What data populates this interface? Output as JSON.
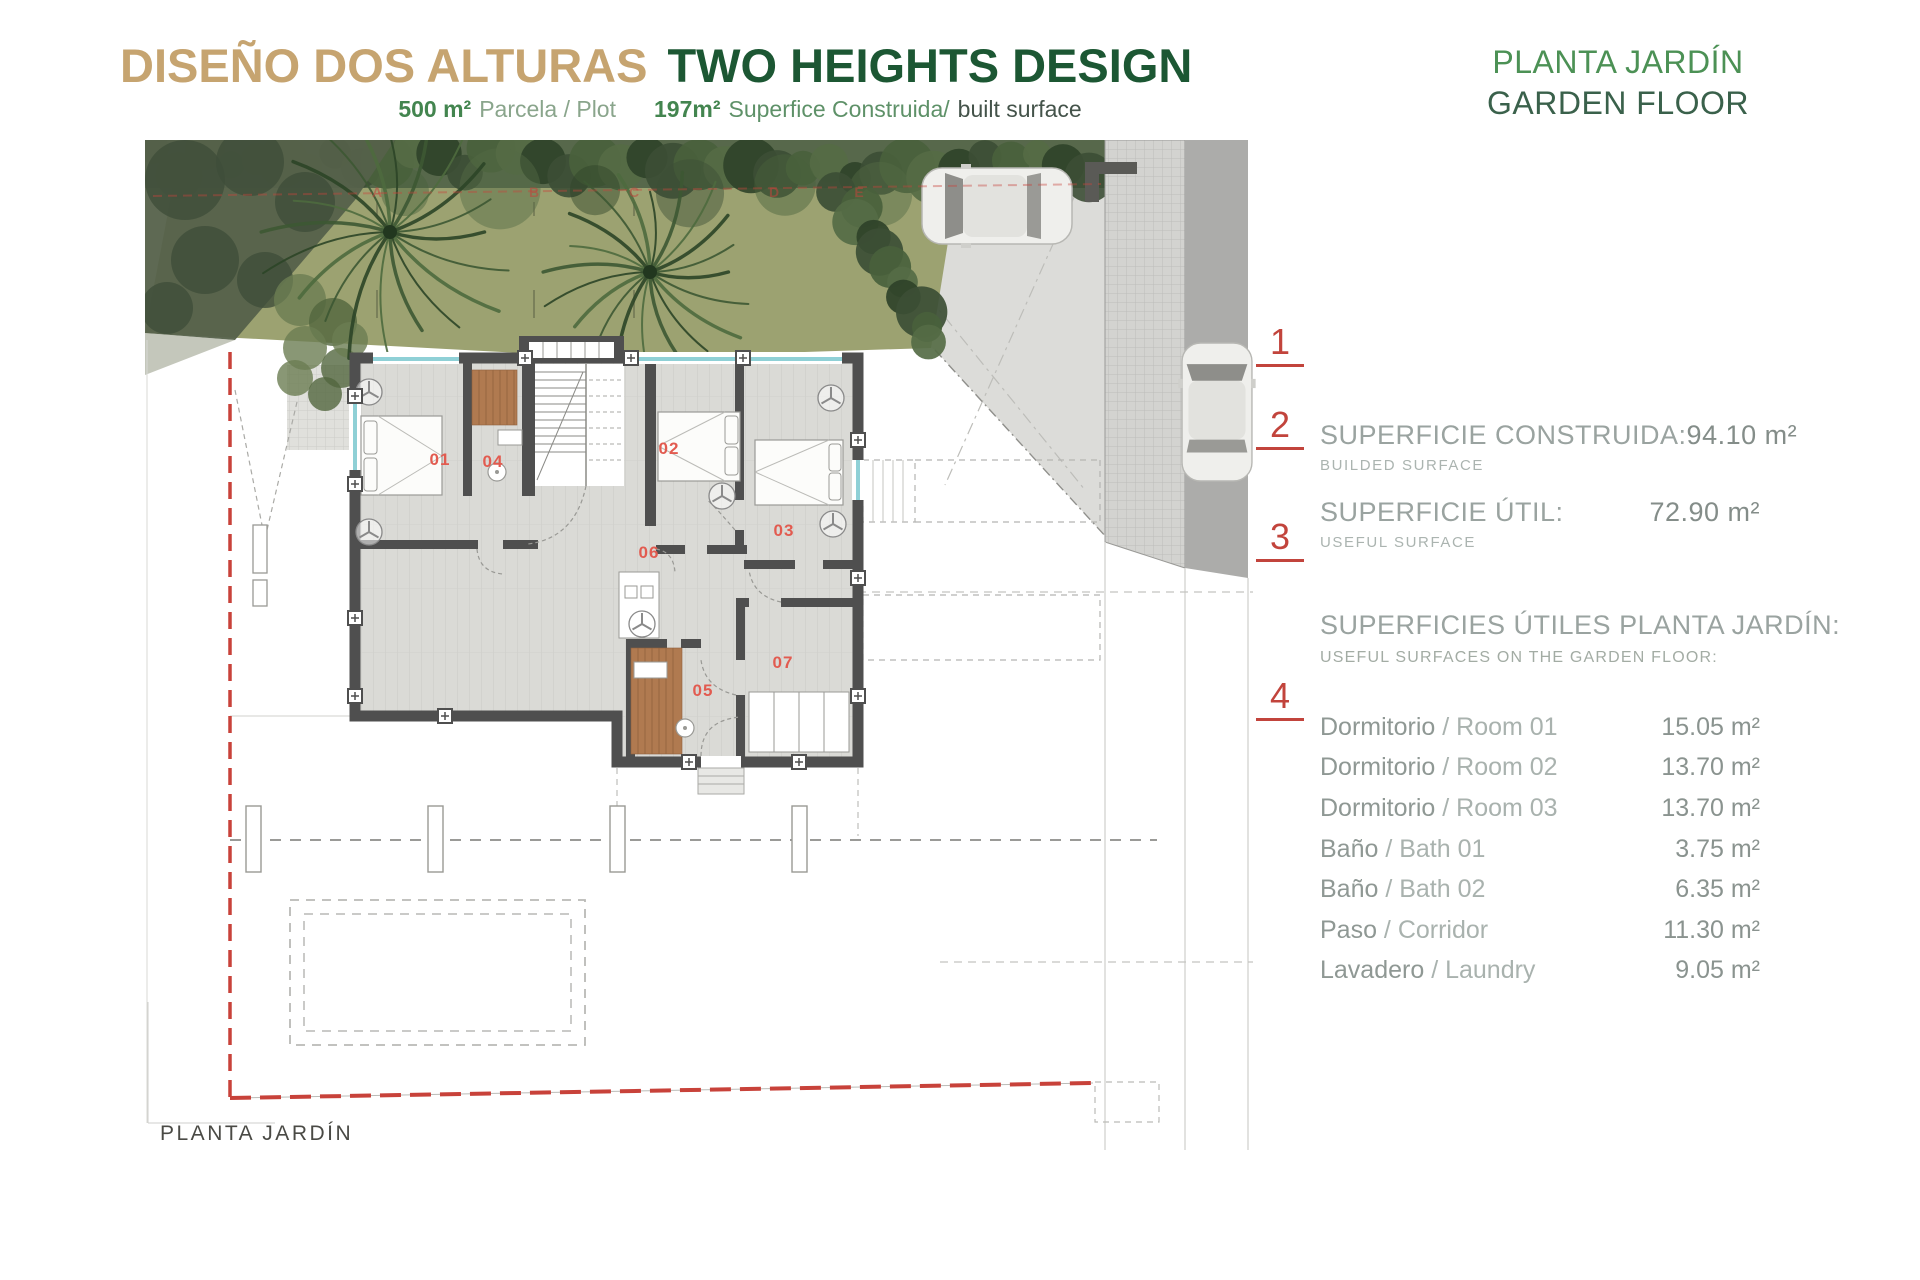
{
  "header": {
    "title_es": "DISEÑO DOS ALTURAS",
    "title_en": "TWO HEIGHTS DESIGN",
    "subtitle": {
      "plot_value": "500 m²",
      "plot_label": "Parcela / Plot",
      "built_value": "197m²",
      "built_label_es": "Superfice Construida/",
      "built_label_en": "built surface"
    },
    "floor_es": "PLANTA JARDÍN",
    "floor_en": "GARDEN FLOOR"
  },
  "panel": {
    "markers": [
      {
        "n": "1"
      },
      {
        "n": "2"
      },
      {
        "n": "3"
      },
      {
        "n": "4"
      }
    ],
    "built_label": "SUPERFICIE CONSTRUIDA:",
    "built_sublabel": "BUILDED SURFACE",
    "built_value": "94.10 m²",
    "useful_label": "SUPERFICIE ÚTIL:",
    "useful_sublabel": "USEFUL SURFACE",
    "useful_value": "72.90 m²",
    "list_title": "SUPERFICIES ÚTILES PLANTA JARDÍN:",
    "list_subtitle": "USEFUL SURFACES ON THE GARDEN FLOOR:",
    "rooms": [
      {
        "name_es": "Dormitorio",
        "name_en": "Room 01",
        "value": "15.05 m²"
      },
      {
        "name_es": "Dormitorio",
        "name_en": "Room 02",
        "value": "13.70 m²"
      },
      {
        "name_es": "Dormitorio",
        "name_en": "Room 03",
        "value": "13.70 m²"
      },
      {
        "name_es": "Baño",
        "name_en": "Bath 01",
        "value": "3.75 m²"
      },
      {
        "name_es": "Baño",
        "name_en": "Bath 02",
        "value": "6.35 m²"
      },
      {
        "name_es": "Paso",
        "name_en": "Corridor",
        "value": "11.30 m²"
      },
      {
        "name_es": "Lavadero",
        "name_en": "Laundry",
        "value": "9.05 m²"
      }
    ]
  },
  "plan": {
    "caption": "PLANTA JARDÍN",
    "room_labels": [
      {
        "id": "01",
        "x": 295,
        "y": 325
      },
      {
        "id": "04",
        "x": 348,
        "y": 327
      },
      {
        "id": "02",
        "x": 524,
        "y": 314
      },
      {
        "id": "03",
        "x": 639,
        "y": 396
      },
      {
        "id": "06",
        "x": 504,
        "y": 418
      },
      {
        "id": "05",
        "x": 558,
        "y": 556
      },
      {
        "id": "07",
        "x": 638,
        "y": 528
      }
    ],
    "grid_letters": [
      {
        "ch": "A",
        "x": 232
      },
      {
        "ch": "B",
        "x": 389
      },
      {
        "ch": "C",
        "x": 489
      },
      {
        "ch": "D",
        "x": 629
      },
      {
        "ch": "E",
        "x": 714
      }
    ]
  },
  "colors": {
    "title_tan": "#C6A470",
    "title_green": "#1C5733",
    "floor_green_light": "#4C9155",
    "accent_red": "#C2443C",
    "room_label_red": "#E25B50",
    "grass": "#9CA271",
    "wall_gray": "#4F4F4F",
    "wood": "#B07A50",
    "window_cyan": "#8FD0D6"
  }
}
